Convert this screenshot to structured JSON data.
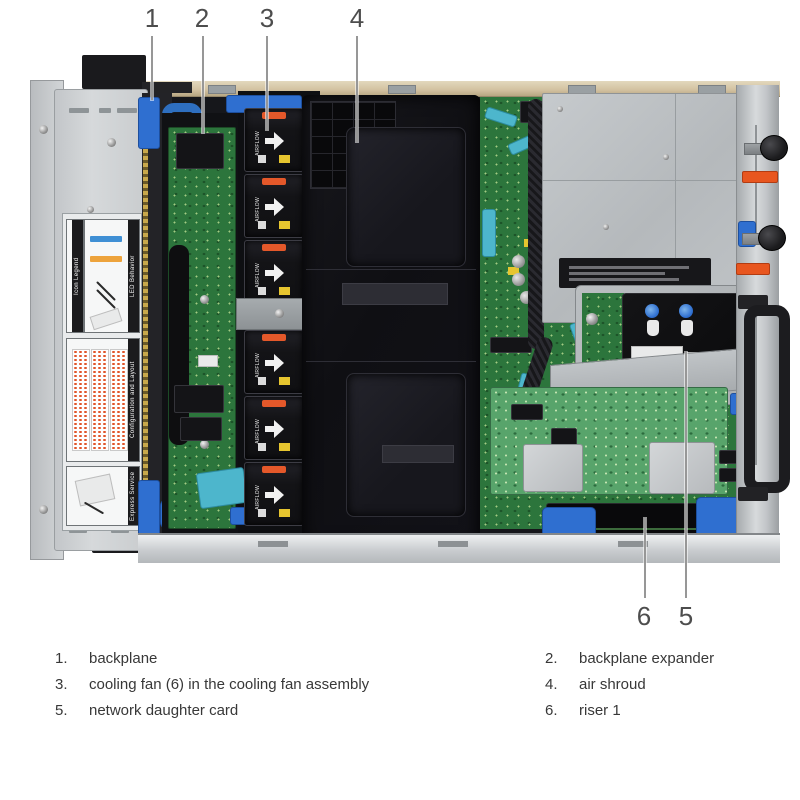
{
  "figure": {
    "description": "Top-down interior view of a 2U rack server chassis with six numbered callouts",
    "palette": {
      "chassis_gray": "#c6c9cb",
      "psu_cover_gray": "#bcc0c3",
      "top_wall_tan": "#d8c8a8",
      "pcb_green": "#2c753c",
      "perc_green": "#58a46b",
      "shroud_black": "#121217",
      "fan_black": "#141416",
      "latch_blue": "#2f6fd0",
      "cable_teal": "#4db6cc",
      "latch_orange": "#e4582a",
      "leader_line_gray": "#979797"
    }
  },
  "callouts": [
    {
      "number": "1",
      "target": "backplane"
    },
    {
      "number": "2",
      "target": "backplane expander"
    },
    {
      "number": "3",
      "target": "cooling fan in the cooling fan assembly"
    },
    {
      "number": "4",
      "target": "air shroud"
    },
    {
      "number": "5",
      "target": "network daughter card"
    },
    {
      "number": "6",
      "target": "riser 1"
    }
  ],
  "legend": {
    "items": [
      {
        "number": "1.",
        "label": "backplane"
      },
      {
        "number": "2.",
        "label": "backplane expander"
      },
      {
        "number": "3.",
        "label": "cooling fan (6) in the cooling fan assembly"
      },
      {
        "number": "4.",
        "label": "air shroud"
      },
      {
        "number": "5.",
        "label": "network daughter card"
      },
      {
        "number": "6.",
        "label": "riser 1"
      }
    ]
  },
  "photo": {
    "sticker_labels": {
      "icon_legend": "Icon Legend",
      "led_behavior": "LED Behavior",
      "configuration": "Configuration and Layout",
      "service_tag": "Express Service Tag"
    },
    "fan_label": "AIRFLOW",
    "ndc_marking": "CE"
  }
}
